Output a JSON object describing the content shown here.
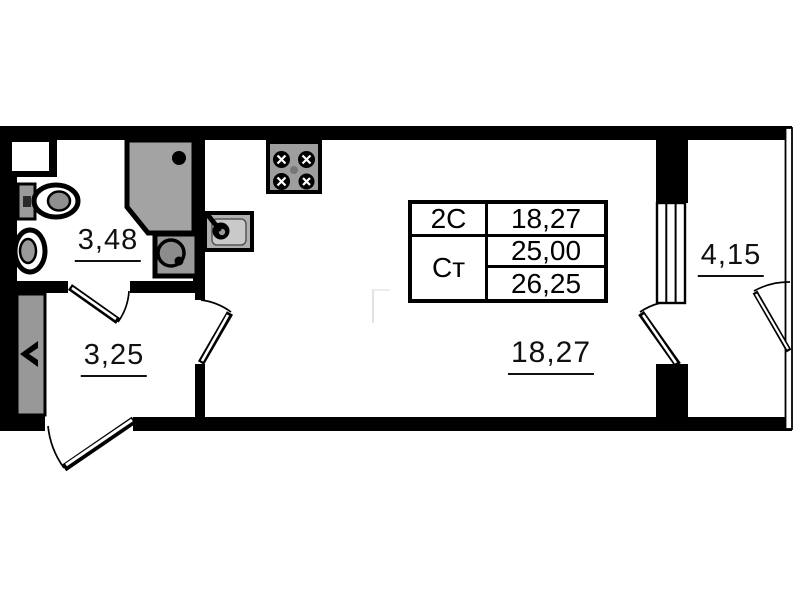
{
  "plan": {
    "rooms": [
      {
        "name": "bathroom",
        "area": "3,48"
      },
      {
        "name": "hallway",
        "area": "3,25"
      },
      {
        "name": "living-room",
        "area": "18,27"
      },
      {
        "name": "balcony",
        "area": "4,15"
      }
    ],
    "info_table": {
      "type_label": "2С",
      "type_area": "18,27",
      "studio_label": "Ст",
      "living_area": "25,00",
      "total_area": "26,25"
    },
    "fixtures": [
      "toilet-icon",
      "washbasin-icon",
      "shower-cabin-icon",
      "washing-machine-icon",
      "kitchen-sink-icon",
      "stove-icon",
      "wardrobe",
      "window",
      "balcony-glazing"
    ],
    "colors": {
      "wall": "#000000",
      "fixture_gray": "#9a9a9a",
      "shower_gray": "#a3a3a3",
      "background": "#ffffff"
    }
  }
}
